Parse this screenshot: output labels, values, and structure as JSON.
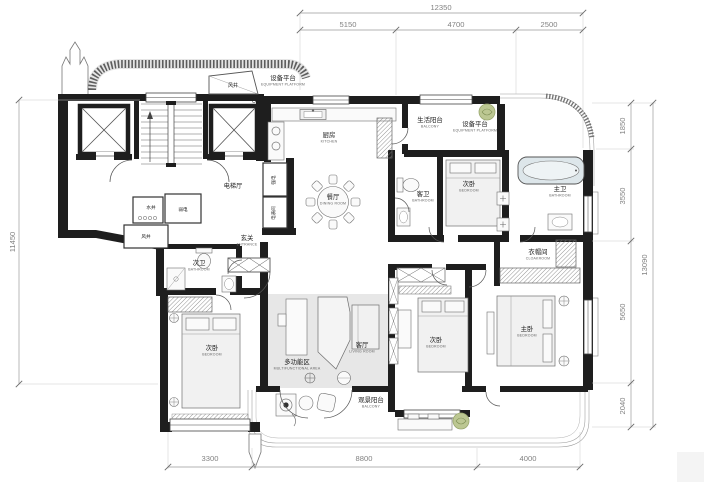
{
  "plan": {
    "type": "residential-floor-plan",
    "rooms": [
      {
        "id": "equipment-platform-top",
        "zh": "设备平台",
        "en": "EQUIPMENT PLATFORM",
        "x": 283,
        "y": 80
      },
      {
        "id": "kitchen",
        "zh": "厨房",
        "en": "KITCHEN",
        "x": 329,
        "y": 137
      },
      {
        "id": "dining-room",
        "zh": "餐厅",
        "en": "DINING ROOM",
        "x": 333,
        "y": 199
      },
      {
        "id": "living-balcony",
        "zh": "生活阳台",
        "en": "BALCONY",
        "x": 430,
        "y": 122
      },
      {
        "id": "equipment-platform-right",
        "zh": "设备平台",
        "en": "EQUIPMENT PLATFORM",
        "x": 475,
        "y": 126
      },
      {
        "id": "bedroom-top-right",
        "zh": "次卧",
        "en": "BEDROOM",
        "x": 469,
        "y": 186
      },
      {
        "id": "guest-bathroom",
        "zh": "客卫",
        "en": "BATHROOM",
        "x": 423,
        "y": 196
      },
      {
        "id": "master-bathroom",
        "zh": "主卫",
        "en": "BATHROOM",
        "x": 560,
        "y": 191
      },
      {
        "id": "cloakroom",
        "zh": "衣帽间",
        "en": "CLOAKROOM",
        "x": 538,
        "y": 254
      },
      {
        "id": "master-bedroom",
        "zh": "主卧",
        "en": "BEDROOM",
        "x": 527,
        "y": 331
      },
      {
        "id": "bedroom-bottom-center",
        "zh": "次卧",
        "en": "BEDROOM",
        "x": 436,
        "y": 342
      },
      {
        "id": "living-room",
        "zh": "客厅",
        "en": "LIVING ROOM",
        "x": 362,
        "y": 347
      },
      {
        "id": "multifunctional-area",
        "zh": "多功能区",
        "en": "MULTIFUNCTIONAL AREA",
        "x": 297,
        "y": 364
      },
      {
        "id": "bedroom-bottom-left",
        "zh": "次卧",
        "en": "BEDROOM",
        "x": 212,
        "y": 350
      },
      {
        "id": "second-bathroom",
        "zh": "次卫",
        "en": "BATHROOM",
        "x": 199,
        "y": 265
      },
      {
        "id": "entrance",
        "zh": "玄关",
        "en": "ENTRANCE",
        "x": 247,
        "y": 240
      },
      {
        "id": "view-balcony",
        "zh": "观景阳台",
        "en": "BALCONY",
        "x": 371,
        "y": 402
      }
    ],
    "utility_labels": [
      {
        "id": "elevator-hall",
        "text": "电梯厅",
        "x": 233,
        "y": 188,
        "fs": 6.2
      },
      {
        "id": "wind-shaft-top",
        "text": "风井",
        "x": 233,
        "y": 87,
        "fs": 5
      },
      {
        "id": "water-shaft",
        "text": "水井",
        "x": 151,
        "y": 209,
        "fs": 4.6
      },
      {
        "id": "weak-electric-room",
        "text": "弱电",
        "x": 183,
        "y": 211,
        "fs": 4.6
      },
      {
        "id": "wind-shaft-mid",
        "text": "风井",
        "x": 146,
        "y": 238,
        "fs": 4.6
      },
      {
        "id": "strong-electric-room",
        "text": "强电",
        "x": 275,
        "y": 180,
        "fs": 4.6,
        "rot": -90
      },
      {
        "id": "meter-room",
        "text": "电表间",
        "x": 275,
        "y": 213,
        "fs": 4.6,
        "rot": -90
      }
    ],
    "dimensions": {
      "top_total": {
        "value": "12350",
        "x": 441,
        "y": 10
      },
      "top_segments": [
        {
          "value": "5150",
          "x": 348,
          "y": 27
        },
        {
          "value": "4700",
          "x": 456,
          "y": 27
        },
        {
          "value": "2500",
          "x": 549,
          "y": 27
        }
      ],
      "right_segments": [
        {
          "value": "1850",
          "x": 625,
          "y": 126,
          "rot": -90
        },
        {
          "value": "3550",
          "x": 625,
          "y": 196,
          "rot": -90
        },
        {
          "value": "5650",
          "x": 625,
          "y": 312,
          "rot": -90
        },
        {
          "value": "2040",
          "x": 625,
          "y": 406,
          "rot": -90
        }
      ],
      "right_total": {
        "value": "13090",
        "x": 647,
        "y": 265,
        "rot": -90
      },
      "left_total": {
        "value": "11450",
        "x": 15,
        "y": 242,
        "rot": -90
      },
      "bottom_segments": [
        {
          "value": "3300",
          "x": 210,
          "y": 461
        },
        {
          "value": "8800",
          "x": 364,
          "y": 461
        },
        {
          "value": "4000",
          "x": 528,
          "y": 461
        }
      ]
    }
  }
}
